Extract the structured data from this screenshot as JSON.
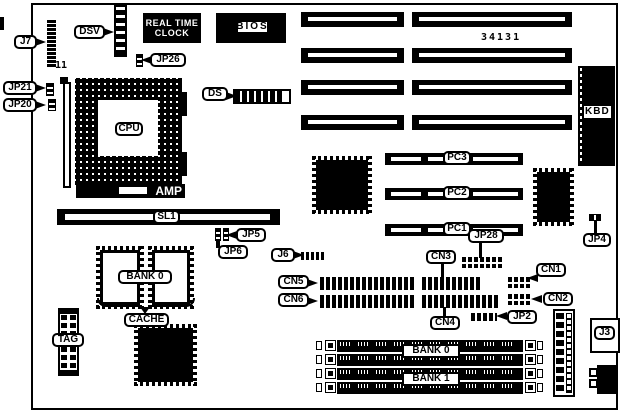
{
  "board": {
    "part_number": "34131",
    "labels": {
      "j7": "J7",
      "j7_pins": "11",
      "dsv": "DSV",
      "rtc_line1": "REAL TIME",
      "rtc_line2": "CLOCK",
      "bios": "BIOS",
      "jp26": "JP26",
      "jp21": "JP21",
      "jp20": "JP20",
      "cpu": "CPU",
      "amp": "AMP",
      "ds": "DS",
      "kbd": "KBD",
      "pc3": "PC3",
      "pc2": "PC2",
      "pc1": "PC1",
      "jp4": "JP4",
      "sl1": "SL1",
      "jp5": "JP5",
      "jp6": "JP6",
      "j6": "J6",
      "cn5": "CN5",
      "cn6": "CN6",
      "cn3": "CN3",
      "cn4": "CN4",
      "cn1": "CN1",
      "cn2": "CN2",
      "jp28": "JP28",
      "jp2": "JP2",
      "bank0_cache": "BANK 0",
      "cache": "CACHE",
      "tag": "TAG",
      "bank0": "BANK 0",
      "bank1": "BANK 1",
      "j3": "J3"
    }
  }
}
